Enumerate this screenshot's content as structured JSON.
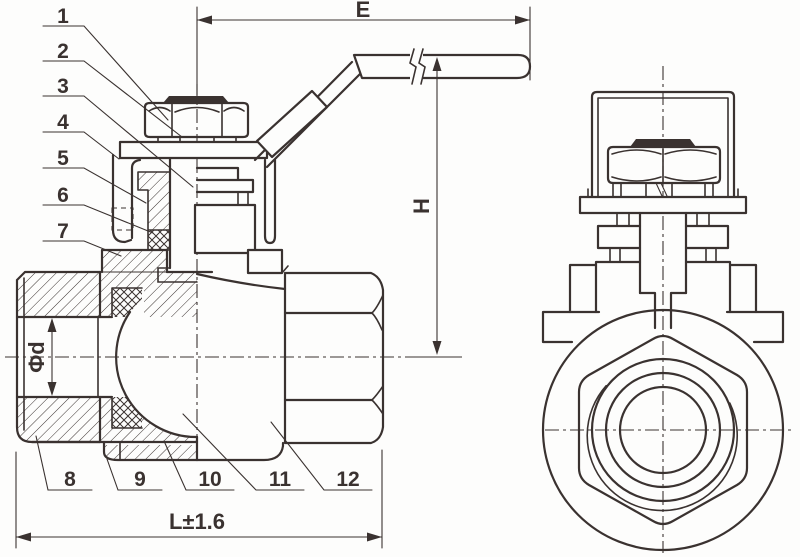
{
  "drawing": {
    "description_labels": {
      "dim_top": "E",
      "dim_height": "H",
      "dim_bore": "Φd",
      "dim_length": "L±1.6"
    },
    "callouts": {
      "items": [
        "1",
        "2",
        "3",
        "4",
        "5",
        "6",
        "7",
        "8",
        "9",
        "10",
        "11",
        "12"
      ]
    },
    "colors": {
      "ink": "#3a3230",
      "paper": "#fdfdfc"
    }
  }
}
